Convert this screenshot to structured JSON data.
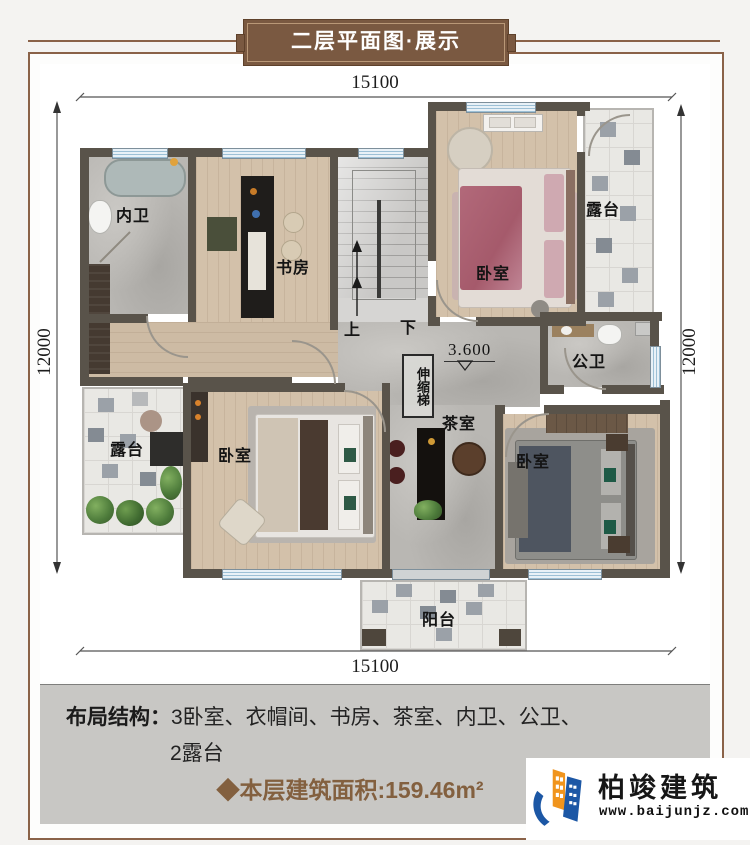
{
  "banner": {
    "title": "二层平面图·展示"
  },
  "dimensions": {
    "top": "15100",
    "bottom": "15100",
    "left": "12000",
    "right": "12000"
  },
  "plan": {
    "rooms": {
      "inner_bath": "内卫",
      "study": "书房",
      "bedroom_top": "卧室",
      "terrace_right": "露台",
      "public_bath": "公卫",
      "tea_room": "茶室",
      "bedroom_left": "卧室",
      "bedroom_right": "卧室",
      "terrace_left": "露台",
      "balcony": "阳台",
      "ladder": "伸缩梯",
      "stairs_up": "上",
      "stairs_down": "下",
      "elevation": "3.600"
    }
  },
  "footer": {
    "layout_label": "布局结构：",
    "layout_line1": "3卧室、衣帽间、书房、茶室、内卫、公卫、",
    "layout_line2": "2露台",
    "area_text": "◆本层建筑面积:159.46m²"
  },
  "logo": {
    "name": "柏竣建筑",
    "website": "www.baijunjz.com"
  },
  "colors": {
    "accent_brown": "#7a5941",
    "wall": "#59534a",
    "logo_blue": "#1c57a5",
    "logo_orange": "#f0941d",
    "footer_gray": "#c8c7c4"
  }
}
